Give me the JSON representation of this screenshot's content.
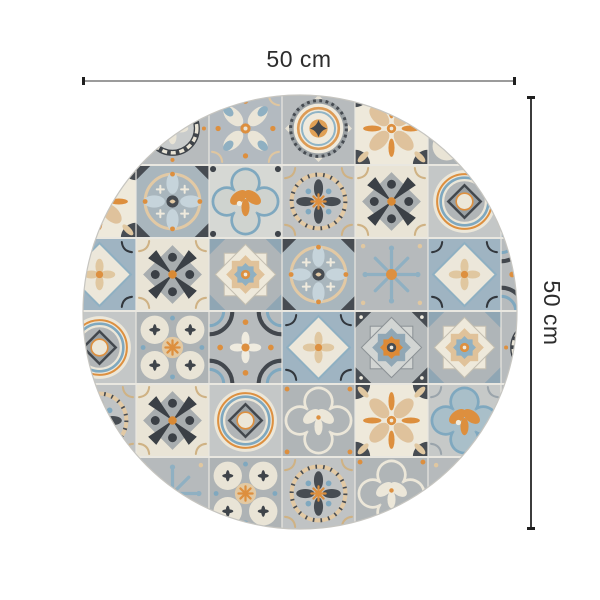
{
  "title": "Round patterned mat dimension diagram",
  "dimensions": {
    "width": {
      "label": "50 cm"
    },
    "height": {
      "label": "50 cm"
    }
  },
  "annotation": {
    "text_color": "#2d2d2d",
    "h_line_color": "#9b9b9b",
    "v_line_color": "#3c3c3c",
    "tick_color": "#1f1f1f"
  },
  "mat": {
    "shape": "circle",
    "description": "Round vinyl mat printed with a patchwork of Mediterranean azulejo cement tiles in grey, blue-grey, cream and orange",
    "center_x": 300,
    "center_y": 312,
    "radius": 217,
    "tile_size": 73,
    "grid_origin_x": 63,
    "grid_origin_y": 92,
    "palette": {
      "cream": "#ece7da",
      "tan": "#e0c49e",
      "orange": "#dd8f3e",
      "blue": "#7fa8bf",
      "blue_light": "#b5c8d2",
      "blue_grey": "#a2b8c4",
      "grey": "#b6babc",
      "grey_light": "#d2d5d4",
      "dark": "#42474d",
      "grout": "#e9e7e0",
      "edge": "#c6c5c0"
    },
    "tile_layout": [
      [
        "arc_flower",
        "wreath",
        "petalcross",
        "medallion",
        "leafcross",
        "fourcircles",
        "petalcross"
      ],
      [
        "leafcross",
        "ellipse_wheel",
        "quatrefoil_blue",
        "laurel",
        "dagger",
        "target",
        "diamond_scroll"
      ],
      [
        "diamond_scroll",
        "dagger",
        "star8_cream",
        "ellipse_wheel",
        "snowflake",
        "diamond_scroll",
        "arc_flower"
      ],
      [
        "target",
        "fourcircles",
        "arc_flower",
        "diamond_scroll",
        "star8_orange",
        "star8_cream",
        "wreath"
      ],
      [
        "laurel",
        "dagger",
        "target",
        "quatrefoil_cream",
        "leafcross",
        "quatrefoil_fill",
        "wreath"
      ],
      [
        "petalcross",
        "snowflake",
        "fourcircles",
        "laurel",
        "quatrefoil_cream",
        "snowflake",
        "dagger"
      ]
    ]
  }
}
